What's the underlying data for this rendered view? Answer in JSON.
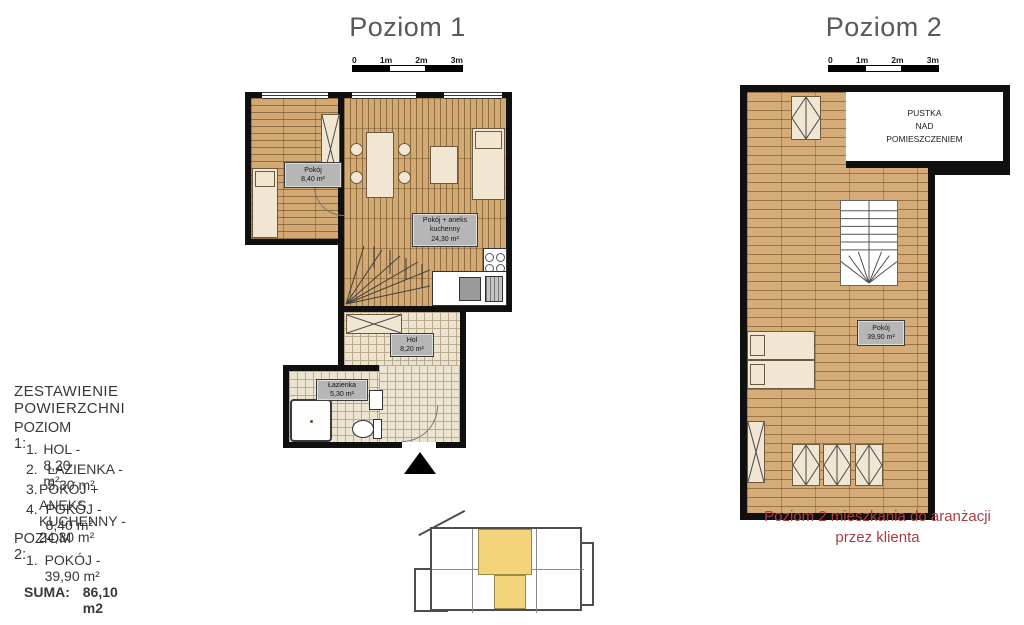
{
  "level1": {
    "title": "Poziom 1",
    "scale_labels": [
      "0",
      "1m",
      "2m",
      "3m"
    ],
    "rooms": {
      "pokoj": {
        "name": "Pokój",
        "area": "8,40 m²"
      },
      "main": {
        "name_line1": "Pokój + aneks",
        "name_line2": "kuchenny",
        "area": "24,30 m²"
      },
      "hol": {
        "name": "Hol",
        "area": "8,20 m²"
      },
      "lazienka": {
        "name": "Łazienka",
        "area": "5,30 m²"
      }
    }
  },
  "level2": {
    "title": "Poziom 2",
    "scale_labels": [
      "0",
      "1m",
      "2m",
      "3m"
    ],
    "void_line1": "PUSTKA",
    "void_line2": "NAD",
    "void_line3": "POMIESZCZENIEM",
    "room": {
      "name": "Pokój",
      "area": "39,90 m²"
    },
    "caption_line1": "Poziom 2 mieszkania do aranżacji",
    "caption_line2": "przez klienta"
  },
  "summary": {
    "heading": "ZESTAWIENIE POWIERZCHNI",
    "poziom1_heading": "POZIOM 1:",
    "poziom1_items": [
      {
        "num": "1.",
        "label": "HOL - 8,20 m²"
      },
      {
        "num": "2.",
        "label": "ŁAZIENKA - 5,30 m²"
      },
      {
        "num": "3.",
        "label": "POKÓJ + ANEKS KUCHENNY - 24,30 m²"
      },
      {
        "num": "4.",
        "label": "POKÓJ - 8,40 m²"
      }
    ],
    "poziom2_heading": "POZIOM 2:",
    "poziom2_items": [
      {
        "num": "1.",
        "label": "POKÓJ - 39,90 m²"
      }
    ],
    "suma_label": "SUMA:",
    "suma_value": "86,10 m2"
  },
  "colors": {
    "wood": "#d2a873",
    "tile": "#ece3d1",
    "wall": "#101010",
    "accent_red": "#a83e44",
    "highlight_yellow": "#f3d47b",
    "title_gray": "#595959",
    "label_bg": "#b6b6b6"
  }
}
